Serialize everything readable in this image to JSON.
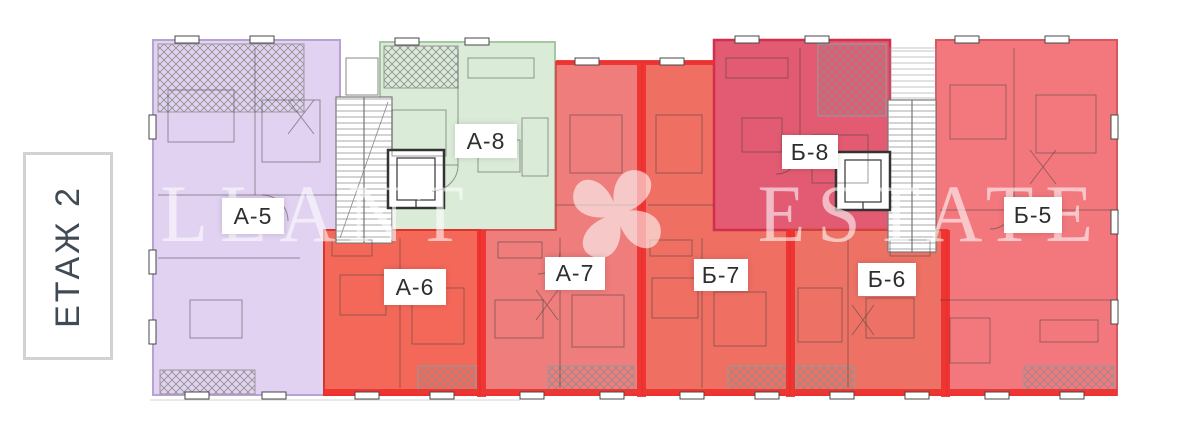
{
  "floor_selector": {
    "label": "ЕТАЖ 2"
  },
  "watermark": {
    "brand_left": "ALLANT",
    "brand_right": "ESTATE",
    "logo_icon": "pinwheel-flower-icon"
  },
  "apartments": [
    {
      "label": "А-5",
      "color": "#e2d2f2"
    },
    {
      "label": "А-6",
      "color": "#f4685a"
    },
    {
      "label": "А-7",
      "color": "#ee7d7c"
    },
    {
      "label": "А-8",
      "color": "#daecd8"
    },
    {
      "label": "Б-5",
      "color": "#f3787e"
    },
    {
      "label": "Б-6",
      "color": "#ed7265"
    },
    {
      "label": "Б-7",
      "color": "#ef6f63"
    },
    {
      "label": "Б-8",
      "color": "#e25b72"
    }
  ],
  "colors": {
    "highlight_wall": "#ee2f2d"
  }
}
